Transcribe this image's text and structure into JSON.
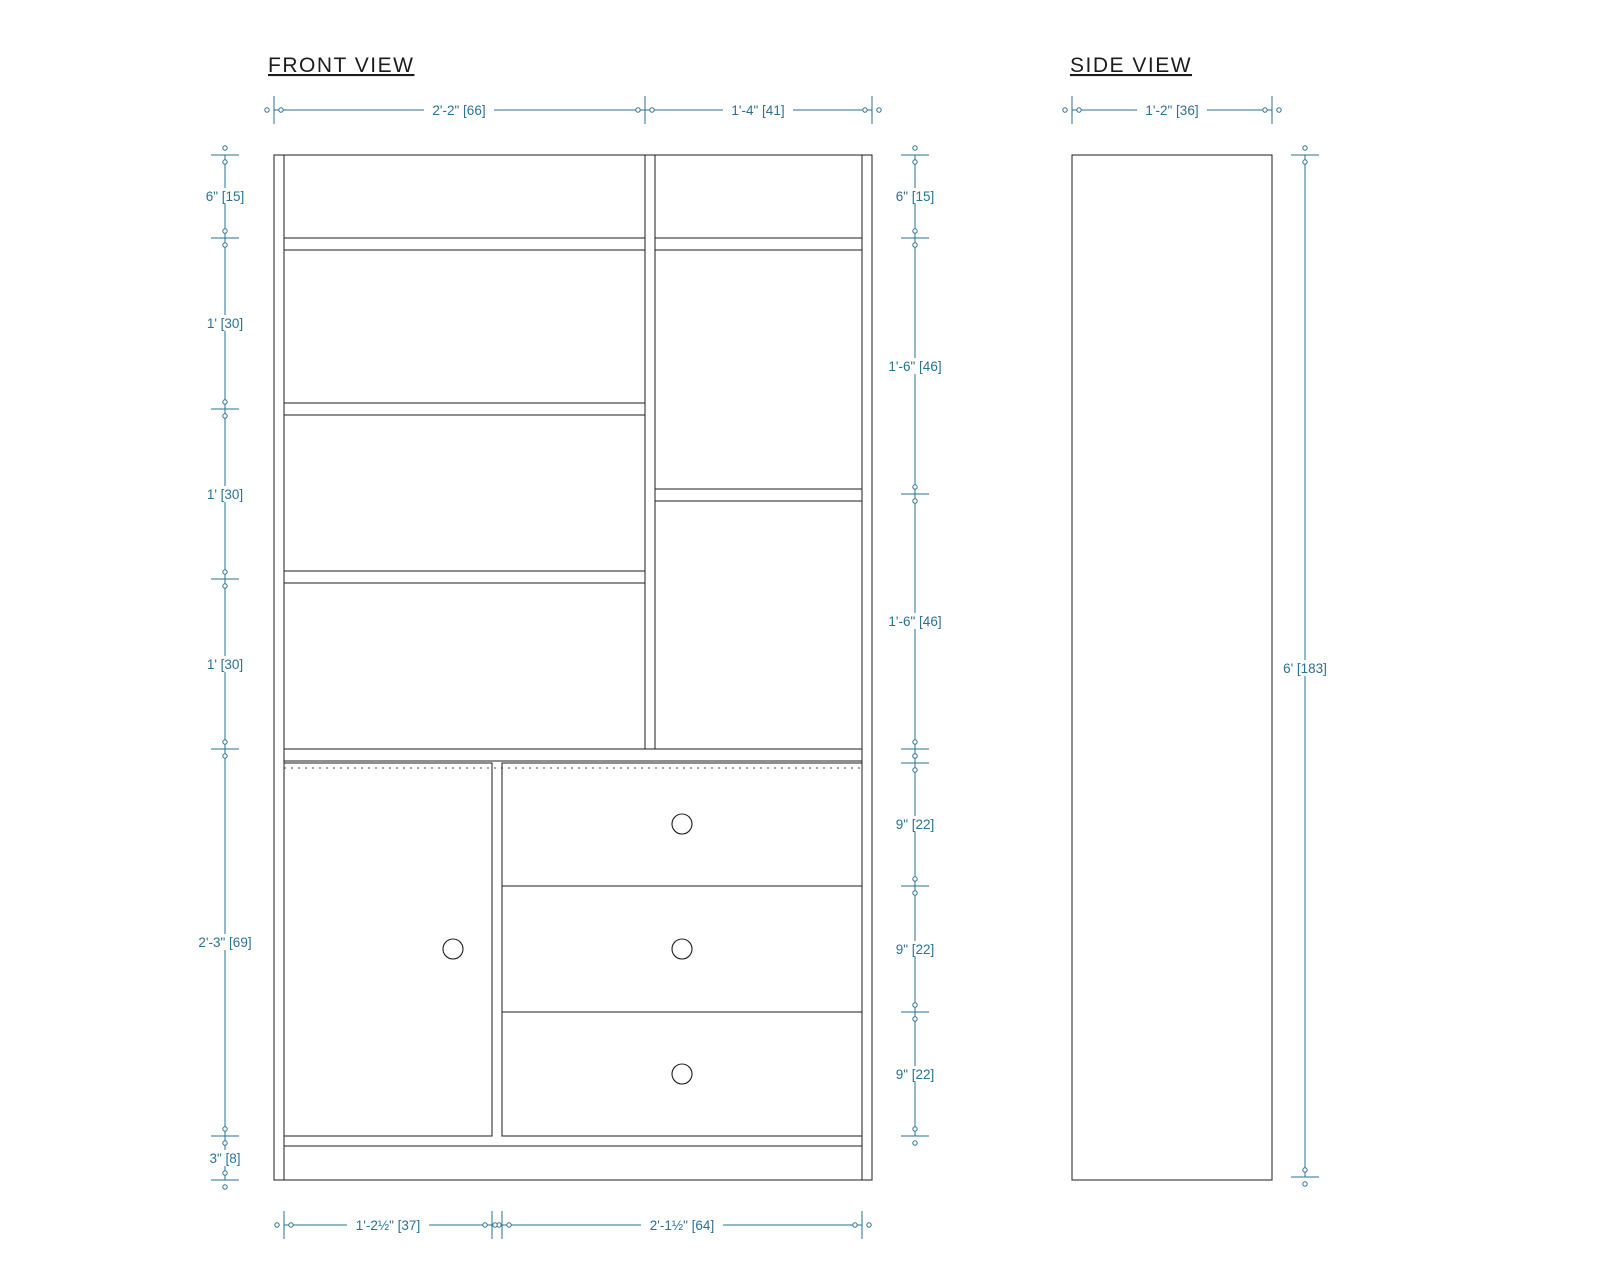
{
  "front_view": {
    "title": "FRONT VIEW",
    "dim_top": [
      "2'-2\" [66]",
      "1'-4\" [41]"
    ],
    "dim_left": [
      "6\" [15]",
      "1' [30]",
      "1' [30]",
      "1' [30]",
      "2'-3\" [69]",
      "3\" [8]"
    ],
    "dim_right": [
      "6\" [15]",
      "1'-6\" [46]",
      "1'-6\" [46]",
      "9\" [22]",
      "9\" [22]",
      "9\" [22]"
    ],
    "dim_bottom": [
      "1'-2½\" [37]",
      "2'-1½\" [64]"
    ]
  },
  "side_view": {
    "title": "SIDE VIEW",
    "dim_top": "1'-2\" [36]",
    "dim_height": "6' [183]"
  },
  "colors": {
    "dimension_accent": "#2a7291",
    "drawing_line": "#1d1d1d",
    "background": "#ffffff"
  }
}
